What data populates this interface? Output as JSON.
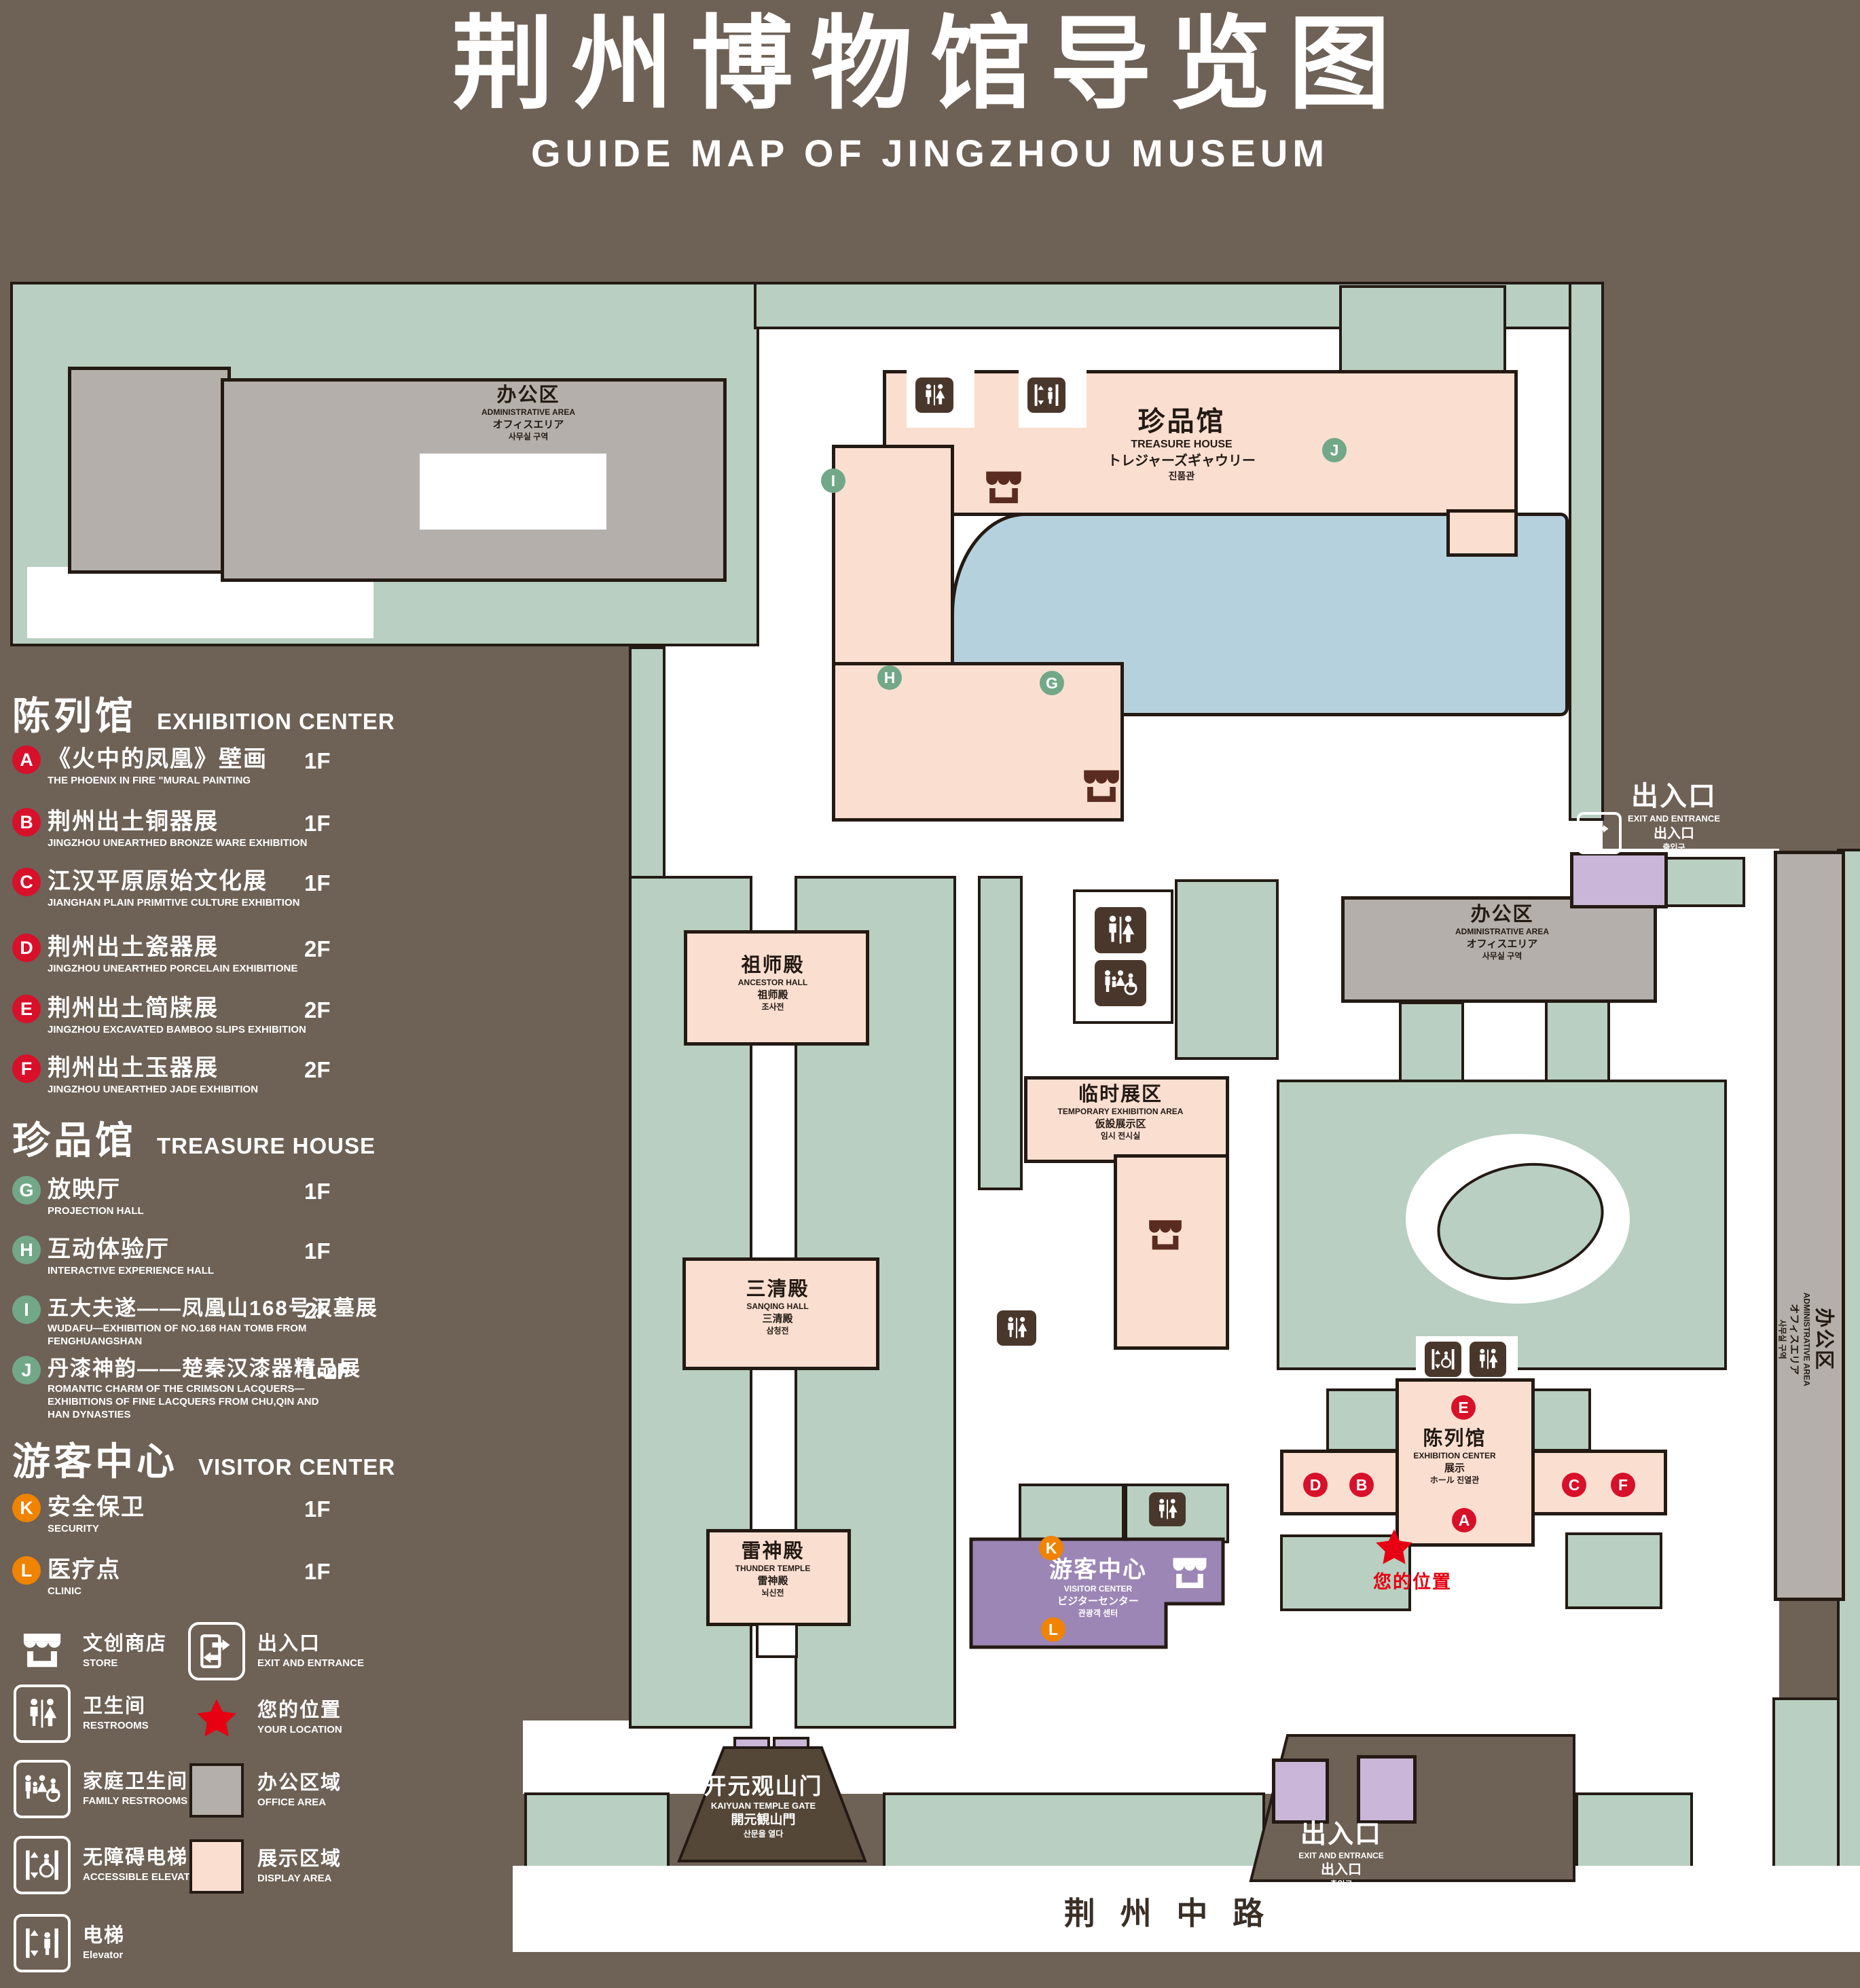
{
  "title": {
    "zh": "荆州博物馆导览图",
    "en": "GUIDE MAP OF JINGZHOU MUSEUM"
  },
  "colors": {
    "background": "#6e6156",
    "lawn_green": "#b8cfc1",
    "display_area": "#fadfd0",
    "office_area": "#b4afaa",
    "water": "#b5d1dd",
    "visitor_center": "#9c86b5",
    "entrance_building": "#c9b6d8",
    "outline": "#241a14",
    "badge_red": "#d8102a",
    "badge_green": "#72a887",
    "badge_orange": "#f08300",
    "location_red": "#e60012"
  },
  "legend": {
    "sections": [
      {
        "zh": "陈列馆",
        "en": "EXHIBITION CENTER",
        "items": [
          {
            "key": "A",
            "zh": "《火中的凤凰》壁画",
            "en": "THE PHOENIX IN FIRE \"MURAL PAINTING",
            "floor": "1F"
          },
          {
            "key": "B",
            "zh": "荆州出土铜器展",
            "en": "JINGZHOU UNEARTHED BRONZE WARE EXHIBITION",
            "floor": "1F"
          },
          {
            "key": "C",
            "zh": "江汉平原原始文化展",
            "en": "JIANGHAN PLAIN PRIMITIVE CULTURE EXHIBITION",
            "floor": "1F"
          },
          {
            "key": "D",
            "zh": "荆州出土瓷器展",
            "en": "JINGZHOU UNEARTHED PORCELAIN EXHIBITIONE",
            "floor": "2F"
          },
          {
            "key": "E",
            "zh": "荆州出土简牍展",
            "en": "JINGZHOU EXCAVATED BAMBOO SLIPS EXHIBITION",
            "floor": "2F"
          },
          {
            "key": "F",
            "zh": "荆州出土玉器展",
            "en": "JINGZHOU UNEARTHED JADE EXHIBITION",
            "floor": "2F"
          }
        ]
      },
      {
        "zh": "珍品馆",
        "en": "TREASURE HOUSE",
        "items": [
          {
            "key": "G",
            "zh": "放映厅",
            "en": "PROJECTION HALL",
            "floor": "1F"
          },
          {
            "key": "H",
            "zh": "互动体验厅",
            "en": "INTERACTIVE EXPERIENCE HALL",
            "floor": "1F"
          },
          {
            "key": "I",
            "zh": "五大夫遂——凤凰山168号汉墓展",
            "en": "WUDAFU—EXHIBITION OF NO.168 HAN TOMB FROM FENGHUANGSHAN",
            "floor": "2F"
          },
          {
            "key": "J",
            "zh": "丹漆神韵——楚秦汉漆器精品展",
            "en": "ROMANTIC CHARM OF THE CRIMSON LACQUERS—EXHIBITIONS OF FINE LACQUERS FROM CHU,QIN AND HAN DYNASTIES",
            "floor": "1-2F"
          }
        ]
      },
      {
        "zh": "游客中心",
        "en": "VISITOR CENTER",
        "items": [
          {
            "key": "K",
            "zh": "安全保卫",
            "en": "SECURITY",
            "floor": "1F"
          },
          {
            "key": "L",
            "zh": "医疗点",
            "en": "CLINIC",
            "floor": "1F"
          }
        ]
      }
    ],
    "symbols": [
      {
        "icon": "store-icon",
        "zh": "文创商店",
        "en": "STORE"
      },
      {
        "icon": "restrooms-icon",
        "zh": "卫生间",
        "en": "RESTROOMS"
      },
      {
        "icon": "family-restrooms-icon",
        "zh": "家庭卫生间",
        "en": "FAMILY RESTROOMS"
      },
      {
        "icon": "accessible-elevator-icon",
        "zh": "无障碍电梯",
        "en": "ACCESSIBLE ELEVATOR"
      },
      {
        "icon": "elevator-icon",
        "zh": "电梯",
        "en": "Elevator"
      },
      {
        "icon": "exit-entrance-icon",
        "zh": "出入口",
        "en": "EXIT AND ENTRANCE"
      },
      {
        "icon": "your-location-icon",
        "zh": "您的位置",
        "en": "YOUR LOCATION"
      },
      {
        "icon": "office-area-swatch",
        "zh": "办公区域",
        "en": "OFFICE AREA"
      },
      {
        "icon": "display-area-swatch",
        "zh": "展示区域",
        "en": "DISPLAY AREA"
      }
    ]
  },
  "map": {
    "buildings": {
      "admin": {
        "lines": [
          "办公区",
          "ADMINISTRATIVE AREA",
          "オフィスエリア",
          "사무실 구역"
        ]
      },
      "treasure": {
        "lines": [
          "珍品馆",
          "TREASURE HOUSE",
          "トレジャーズギャウリー",
          "진품관"
        ]
      },
      "ancestor": {
        "lines": [
          "祖师殿",
          "ANCESTOR HALL",
          "祖师殿",
          "조사전"
        ]
      },
      "temporary": {
        "lines": [
          "临时展区",
          "TEMPORARY EXHIBITION AREA",
          "仮設展示区",
          "임시 전시실"
        ]
      },
      "sanqing": {
        "lines": [
          "三清殿",
          "SANQING HALL",
          "三清殿",
          "삼청전"
        ]
      },
      "thunder": {
        "lines": [
          "雷神殿",
          "THUNDER TEMPLE",
          "雷神殿",
          "뇌신전"
        ]
      },
      "visitor": {
        "lines": [
          "游客中心",
          "VISITOR CENTER",
          "ビジターセンター",
          "관광객 센터"
        ]
      },
      "exhibition": {
        "lines": [
          "陈列馆",
          "EXHIBITION CENTER",
          "展示",
          "ホール 진열관"
        ]
      },
      "gate": {
        "lines": [
          "开元观山门",
          "KAIYUAN TEMPLE GATE",
          "開元観山門",
          "산문을 열다"
        ]
      }
    },
    "exit": {
      "lines": [
        "出入口",
        "EXIT AND ENTRANCE",
        "出入口",
        "출입구"
      ]
    },
    "road": {
      "name": "荆 州 中 路"
    },
    "your_location": {
      "zh": "您的位置"
    }
  }
}
